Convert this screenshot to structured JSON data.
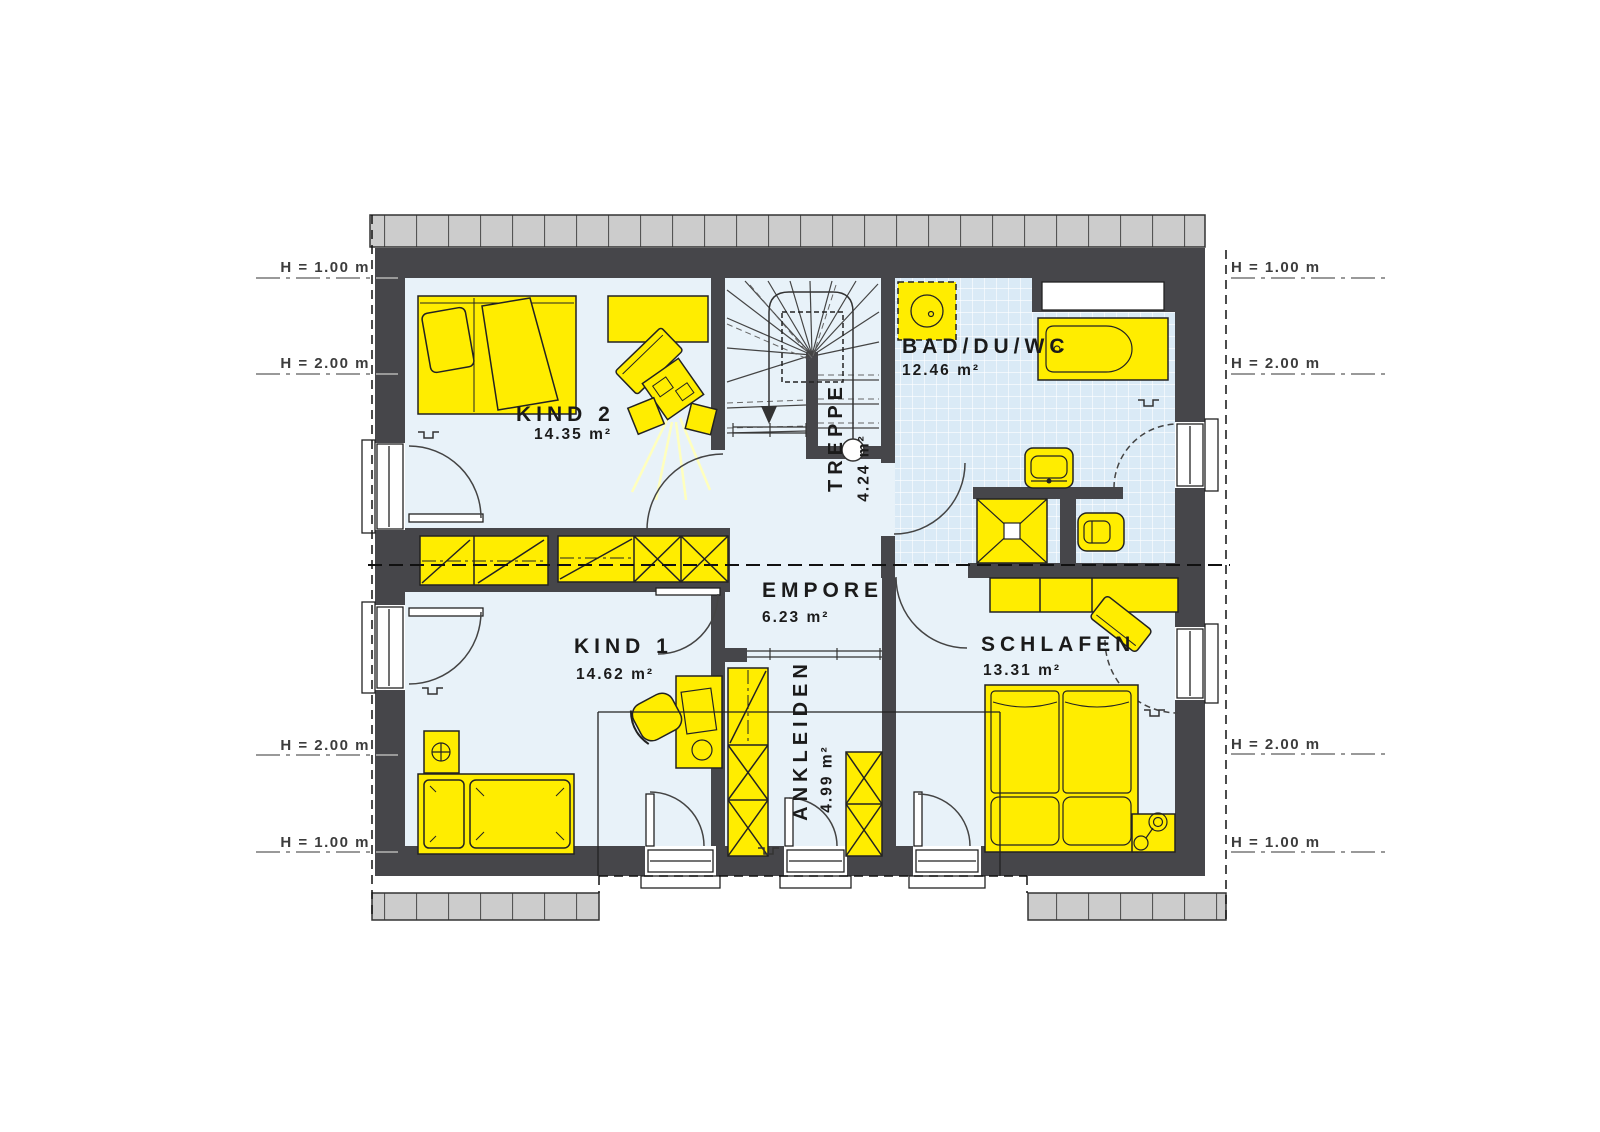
{
  "plan": {
    "rooms": {
      "kind2": {
        "name": "KIND 2",
        "area": "14.35 m²"
      },
      "kind1": {
        "name": "KIND 1",
        "area": "14.62 m²"
      },
      "empore": {
        "name": "EMPORE",
        "area": "6.23 m²"
      },
      "treppe": {
        "name": "TREPPE",
        "area": "4.24 m²"
      },
      "ankleiden": {
        "name": "ANKLEIDEN",
        "area": "4.99 m²"
      },
      "bad": {
        "name": "BAD/DU/WC",
        "area": "12.46 m²"
      },
      "schlafen": {
        "name": "SCHLAFEN",
        "area": "13.31 m²"
      }
    },
    "height_markers": {
      "top_left": [
        "H = 1.00 m",
        "H = 2.00 m"
      ],
      "bottom_left": [
        "H = 2.00 m",
        "H = 1.00 m"
      ],
      "top_right": [
        "H = 1.00 m",
        "H = 2.00 m"
      ],
      "bottom_right": [
        "H = 2.00 m",
        "H = 1.00 m"
      ]
    },
    "colors": {
      "wall": "#46464a",
      "furniture": "#ffed00",
      "floor": "#e8f2f9",
      "tiles": "#daeaf6",
      "roof": "#cccccc"
    }
  }
}
